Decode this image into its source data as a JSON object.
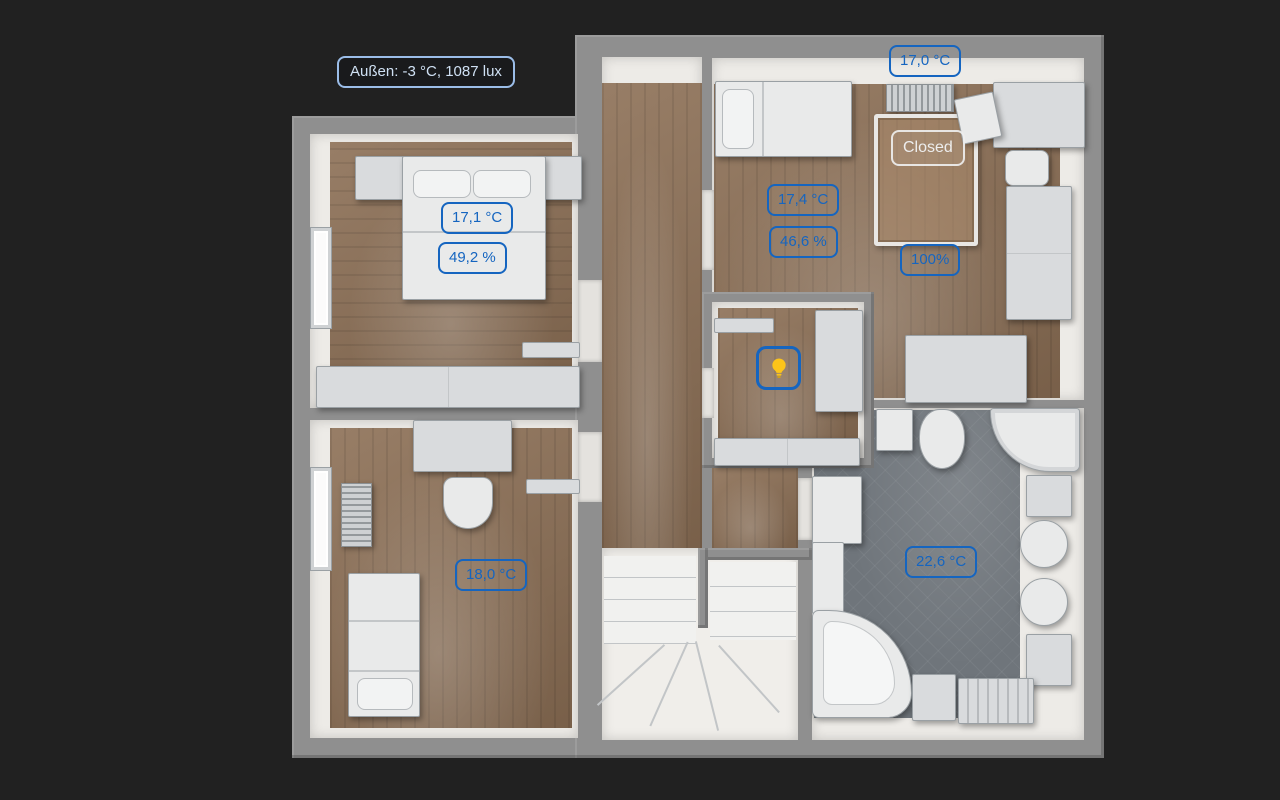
{
  "overlays": {
    "outside": {
      "label": "Außen: -3 °C, 1087 lux"
    },
    "bedroom_left": {
      "temperature": "17,1 °C",
      "humidity": "49,2 %"
    },
    "bedroom_right": {
      "radiator_temperature": "17,0 °C",
      "temperature": "17,4 °C",
      "humidity": "46,6 %",
      "roof_window_state": "Closed",
      "shutter_position": "100%"
    },
    "office": {
      "temperature": "18,0 °C"
    },
    "bathroom": {
      "temperature": "22,6 °C"
    },
    "hallway_closet": {
      "light_state": "on",
      "light_icon": "lightbulb-on-icon"
    }
  },
  "colors": {
    "background": "#212121",
    "accent_blue": "#1565c0",
    "outside_badge_border": "#9bbde8",
    "outside_badge_text": "#cfe0f3",
    "closed_badge": "#ededed",
    "light_on_yellow": "#fcc419",
    "wall_gray": "#8f8f8f",
    "wood_floor": "#8c6f55",
    "tile_floor": "#6f757b"
  }
}
